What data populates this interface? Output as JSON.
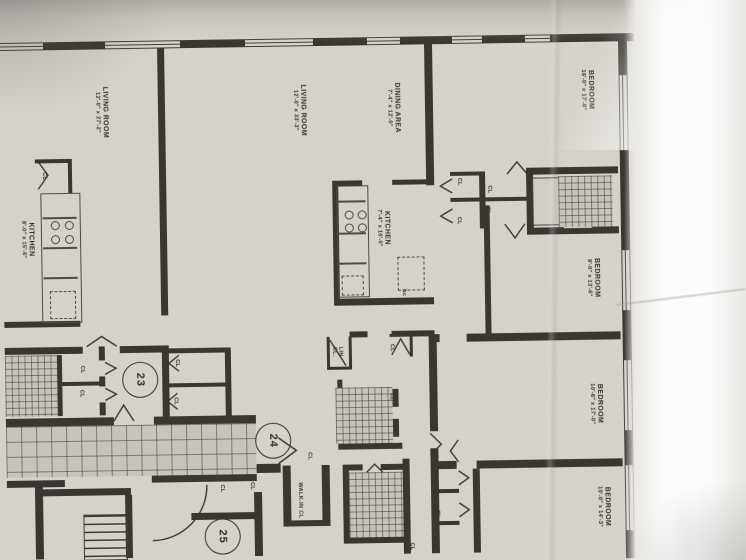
{
  "photo_colors": {
    "paper": "#d5d2cb",
    "ink": "#35322d",
    "glare": "#fdfdfc"
  },
  "rooms": {
    "living_left": {
      "name": "LIVING ROOM",
      "dims": "12'-0\" x 27'-2\""
    },
    "living_center": {
      "name": "LIVING ROOM",
      "dims": "12'-0\" x 33'-2\""
    },
    "dining": {
      "name": "DINING AREA",
      "dims": "7'-4\" x 12'-0\""
    },
    "kitchen_left": {
      "name": "KITCHEN",
      "dims": "8'-0\" x 15'-6\""
    },
    "kitchen_center": {
      "name": "KITCHEN",
      "dims": "7'-4\" x 10'-0\""
    },
    "bedroom_1": {
      "name": "BEDROOM",
      "dims": "16'-0\" x 17'-0\""
    },
    "bedroom_2": {
      "name": "BEDROOM",
      "dims": "9'-0\" x 13'-6\""
    },
    "bedroom_3": {
      "name": "BEDROOM",
      "dims": "10'-6\" x 17'-0\""
    },
    "bedroom_4": {
      "name": "BEDROOM",
      "dims": "10'-0\" x 14'-3\""
    }
  },
  "closets": {
    "cl": "CL",
    "lin_cl": "LIN CL.",
    "walk_in_cl": "WALK-IN CL",
    "bc": "bc"
  },
  "unit_numbers": {
    "u23": "23",
    "u24": "24",
    "u25": "25"
  }
}
